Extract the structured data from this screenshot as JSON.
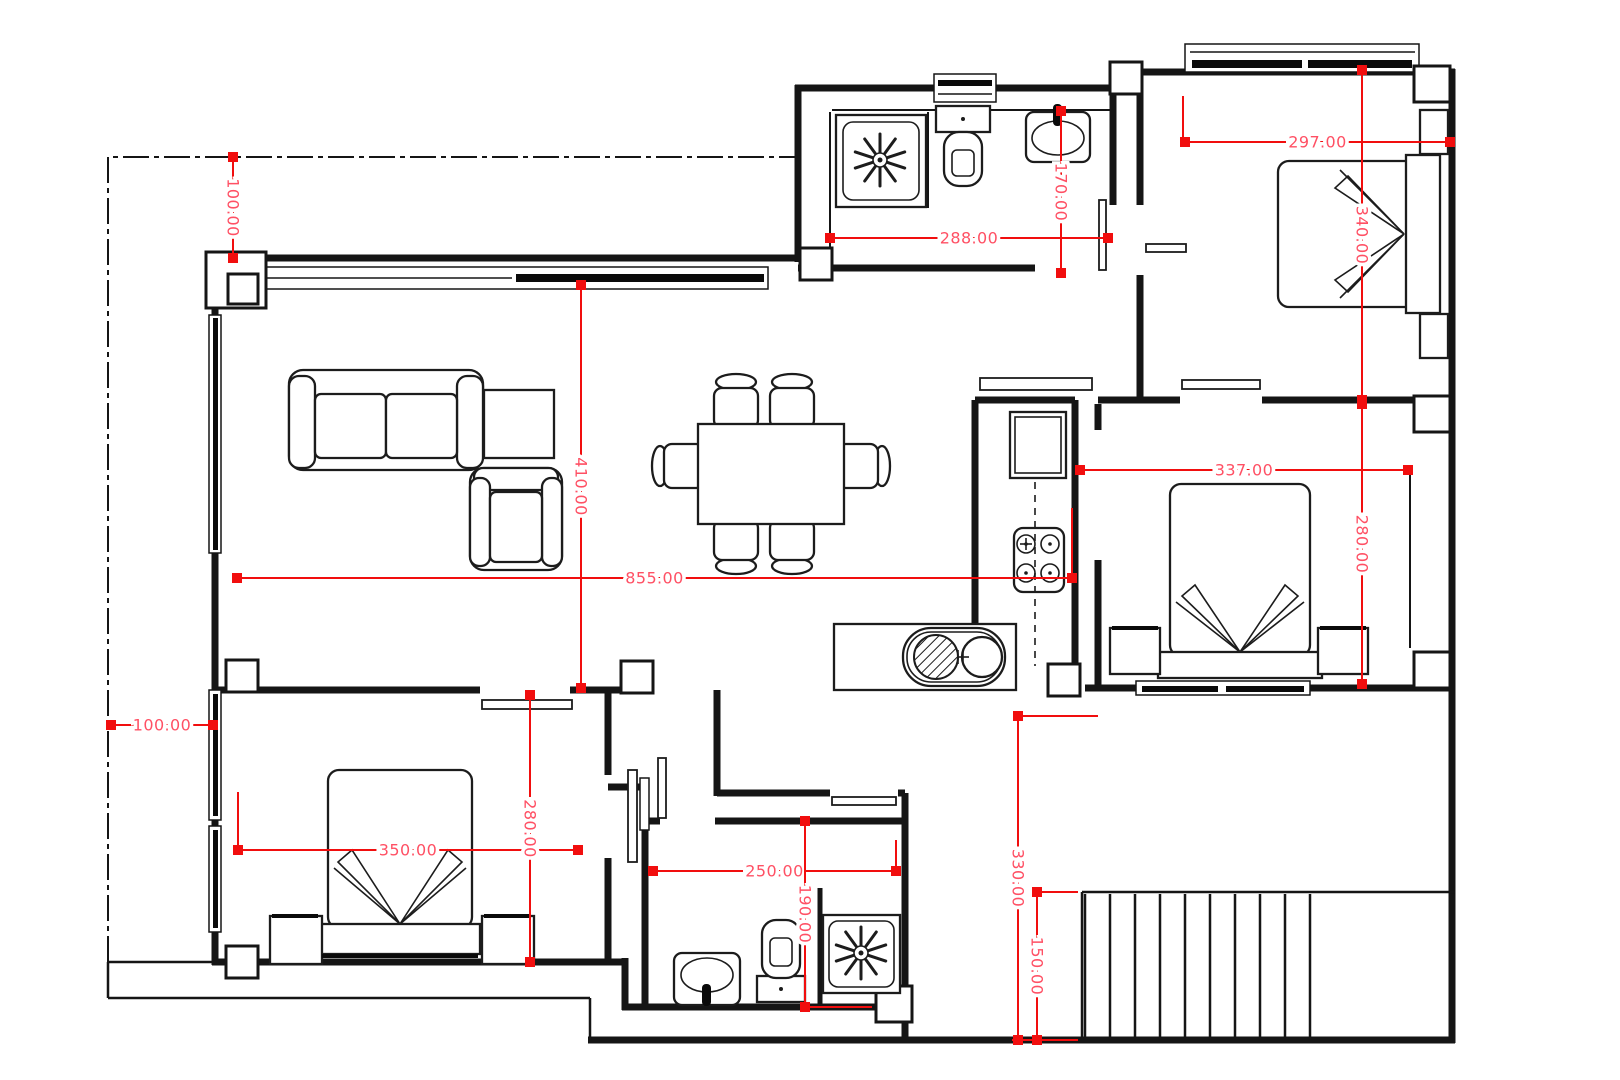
{
  "drawing_type": "architectural-floor-plan",
  "canvas": {
    "width": 1620,
    "height": 1080
  },
  "colors": {
    "background": "#ffffff",
    "walls": "#151515",
    "furniture": "#1c1c1c",
    "dimension_line": "#f10e0e",
    "dimension_square": "#f10e0e",
    "dimension_text": "#ff5064"
  },
  "dimensions": [
    {
      "id": "setback-top",
      "label": "100.00",
      "x1": 233,
      "y1": 157,
      "x2": 233,
      "y2": 258,
      "orient": "v"
    },
    {
      "id": "setback-left",
      "label": "100.00",
      "x1": 111,
      "y1": 725,
      "x2": 213,
      "y2": 725,
      "orient": "h"
    },
    {
      "id": "bath1-width",
      "label": "288.00",
      "x1": 830,
      "y1": 238,
      "x2": 1108,
      "y2": 238,
      "orient": "h"
    },
    {
      "id": "bath1-depth",
      "label": "170.00",
      "x1": 1061,
      "y1": 111,
      "x2": 1061,
      "y2": 273,
      "orient": "v"
    },
    {
      "id": "bedroom1-width",
      "label": "297.00",
      "x1": 1185,
      "y1": 142,
      "x2": 1450,
      "y2": 142,
      "orient": "h"
    },
    {
      "id": "bedroom1-depth",
      "label": "340.00",
      "x1": 1362,
      "y1": 70,
      "x2": 1362,
      "y2": 400,
      "orient": "v"
    },
    {
      "id": "bedroom2-width",
      "label": "337.00",
      "x1": 1080,
      "y1": 470,
      "x2": 1408,
      "y2": 470,
      "orient": "h"
    },
    {
      "id": "bedroom2-depth",
      "label": "280.00",
      "x1": 1362,
      "y1": 404,
      "x2": 1362,
      "y2": 684,
      "orient": "v"
    },
    {
      "id": "living-depth",
      "label": "410.00",
      "x1": 581,
      "y1": 285,
      "x2": 581,
      "y2": 688,
      "orient": "v"
    },
    {
      "id": "living-width",
      "label": "855.00",
      "x1": 237,
      "y1": 578,
      "x2": 1072,
      "y2": 578,
      "orient": "h"
    },
    {
      "id": "bedroom3-width",
      "label": "350.00",
      "x1": 238,
      "y1": 850,
      "x2": 578,
      "y2": 850,
      "orient": "h"
    },
    {
      "id": "bedroom3-depth",
      "label": "280.00",
      "x1": 530,
      "y1": 695,
      "x2": 530,
      "y2": 962,
      "orient": "v"
    },
    {
      "id": "bath2-width",
      "label": "250.00",
      "x1": 653,
      "y1": 871,
      "x2": 896,
      "y2": 871,
      "orient": "h"
    },
    {
      "id": "bath2-depth",
      "label": "190.00",
      "x1": 805,
      "y1": 821,
      "x2": 805,
      "y2": 1007,
      "orient": "v"
    },
    {
      "id": "terrace-depth",
      "label": "330.00",
      "x1": 1018,
      "y1": 716,
      "x2": 1018,
      "y2": 1040,
      "orient": "v"
    },
    {
      "id": "stairs-depth",
      "label": "150.00",
      "x1": 1037,
      "y1": 892,
      "x2": 1037,
      "y2": 1040,
      "orient": "v"
    }
  ],
  "extension_lines": [
    [
      1018,
      716,
      1098,
      716
    ],
    [
      1037,
      892,
      1078,
      892
    ],
    [
      1012,
      1040,
      1078,
      1040
    ],
    [
      238,
      792,
      238,
      848
    ],
    [
      1072,
      508,
      1072,
      576
    ],
    [
      1183,
      96,
      1183,
      146
    ],
    [
      896,
      840,
      896,
      872
    ],
    [
      807,
      1007,
      872,
      1007
    ]
  ],
  "stairs": {
    "riser_count": 10,
    "x_start": 1085,
    "x_step": 25,
    "y_top": 894,
    "y_bottom": 1038
  },
  "shower_stars": [
    [
      880,
      160
    ],
    [
      861,
      953
    ]
  ]
}
